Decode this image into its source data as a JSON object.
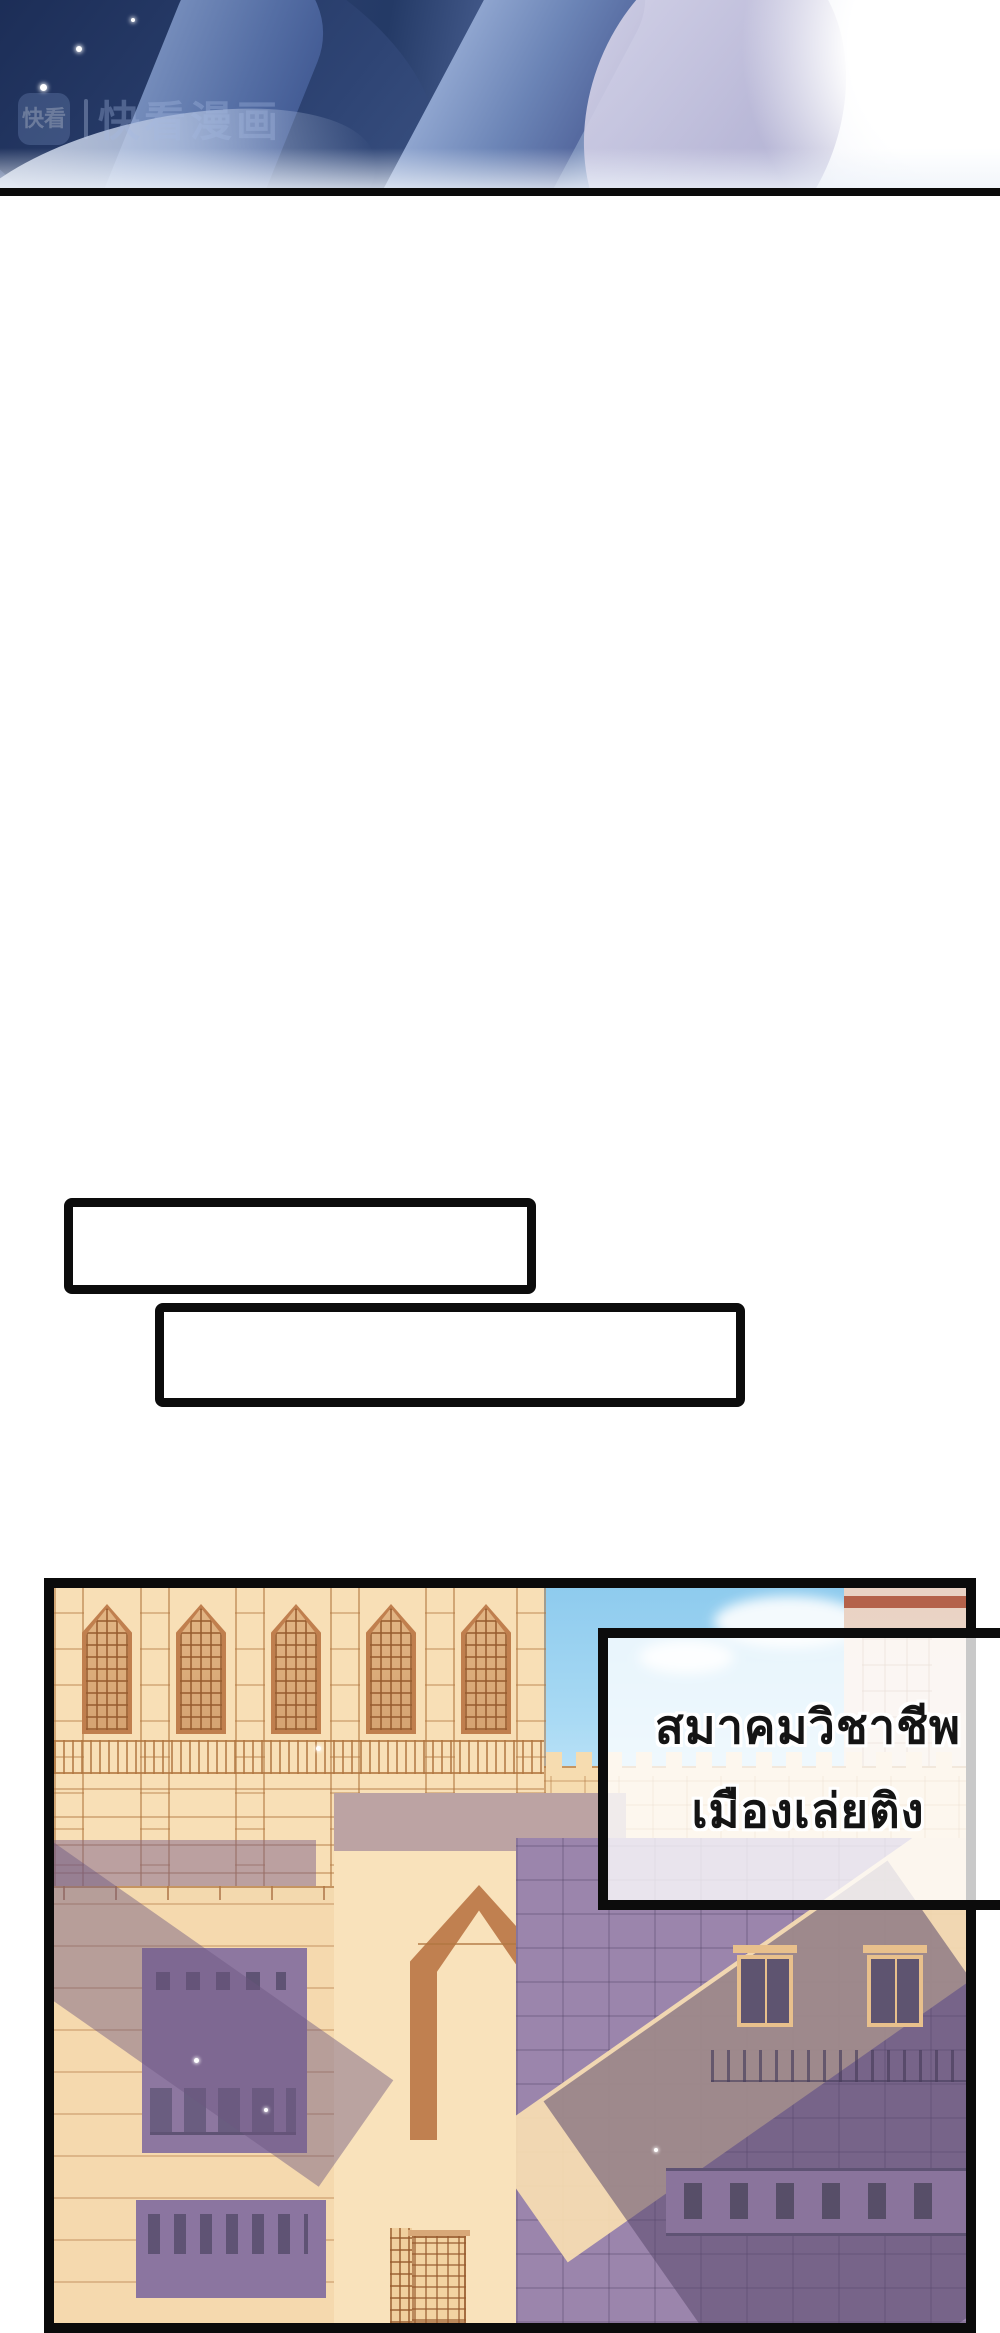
{
  "page": {
    "width": 1000,
    "height": 2333,
    "background": "#ffffff",
    "description": "vertical webtoon strip page"
  },
  "top_panel": {
    "description": "cropped close-up of dark blue anime hair sweeping diagonally into bright white light",
    "watermark": {
      "logo_text": "快看",
      "brand_text": "快看漫画"
    }
  },
  "speech_boxes": [
    {
      "text": ""
    },
    {
      "text": ""
    }
  ],
  "bottom_panel": {
    "description": "sunlit tan palace cityscape with gothic arched windows, crenellated walls and purple shadows under blue sky",
    "caption": {
      "line1": "สมาคมวิชาชีพ",
      "line2": "เมืองเล่ยติง"
    }
  },
  "colors": {
    "panel_border": "#0b0b0b",
    "hair_dark": "#2b3f6e",
    "hair_light": "#8ea4cc",
    "sky_blue": "#a9daf4",
    "building_tan": "#f8dfb6",
    "building_line": "#c08050",
    "shadow_purple": "#9b85ac",
    "caption_fill": "rgba(255,255,255,0.78)",
    "caption_text": "#141414"
  }
}
